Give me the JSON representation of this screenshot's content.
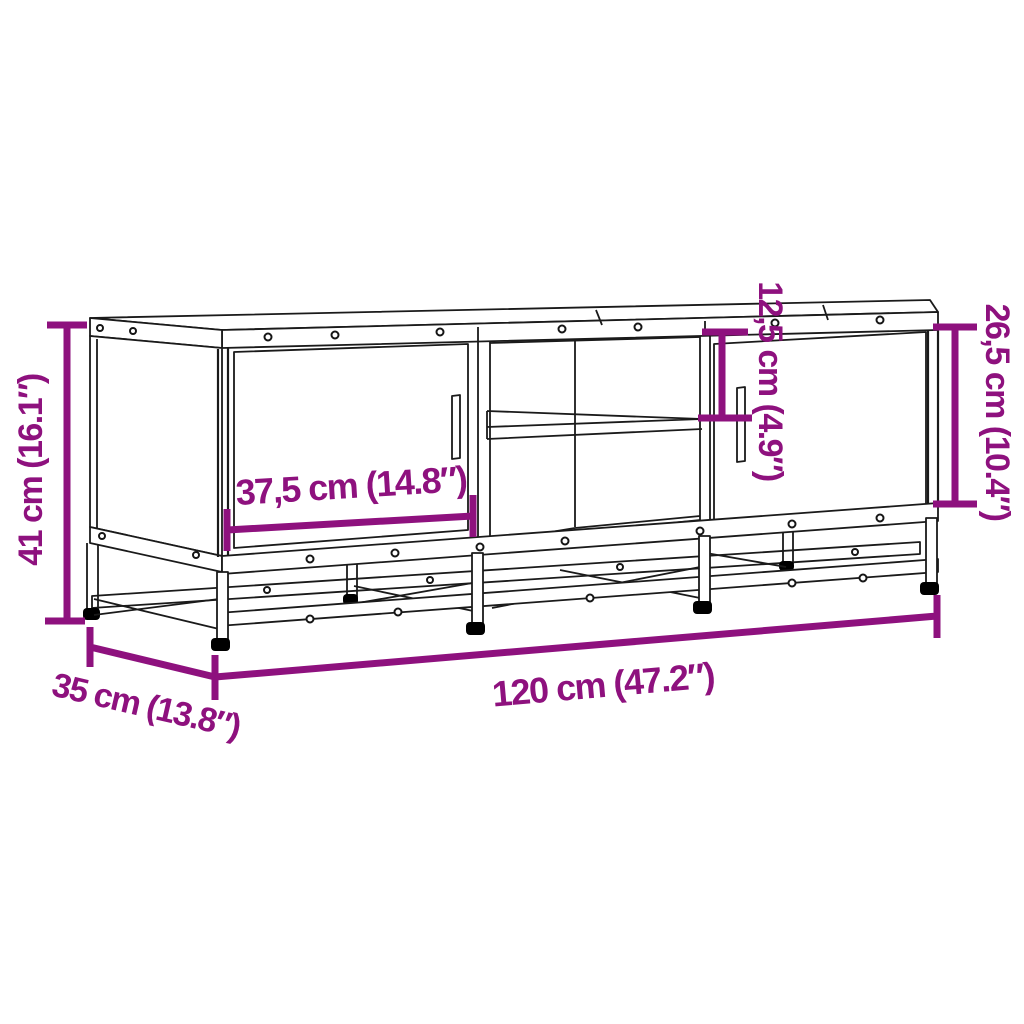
{
  "colors": {
    "dimension_annotation": "#8E117E",
    "linework": "#1A1A1A",
    "background": "#FFFFFF",
    "feet": "#000000"
  },
  "product": {
    "name": "TV cabinet with two doors, open middle shelf and metal base frame",
    "style": "black line drawing, front three-quarter view"
  },
  "dimensions": {
    "overall_height": {
      "label": "41 cm (16.1″)",
      "value_cm": "41",
      "value_inch": "16.1"
    },
    "overall_width": {
      "label": "120 cm (47.2″)",
      "value_cm": "120",
      "value_inch": "47.2"
    },
    "overall_depth": {
      "label": "35 cm (13.8″)",
      "value_cm": "35",
      "value_inch": "13.8"
    },
    "door_width": {
      "label": "37,5 cm (14.8″)",
      "value_cm": "37,5",
      "value_inch": "14.8"
    },
    "compartment_height": {
      "label": "12,5 cm (4.9″)",
      "value_cm": "12,5",
      "value_inch": "4.9"
    },
    "door_opening_height": {
      "label": "26,5 cm (10.4″)",
      "value_cm": "26,5",
      "value_inch": "10.4"
    }
  }
}
